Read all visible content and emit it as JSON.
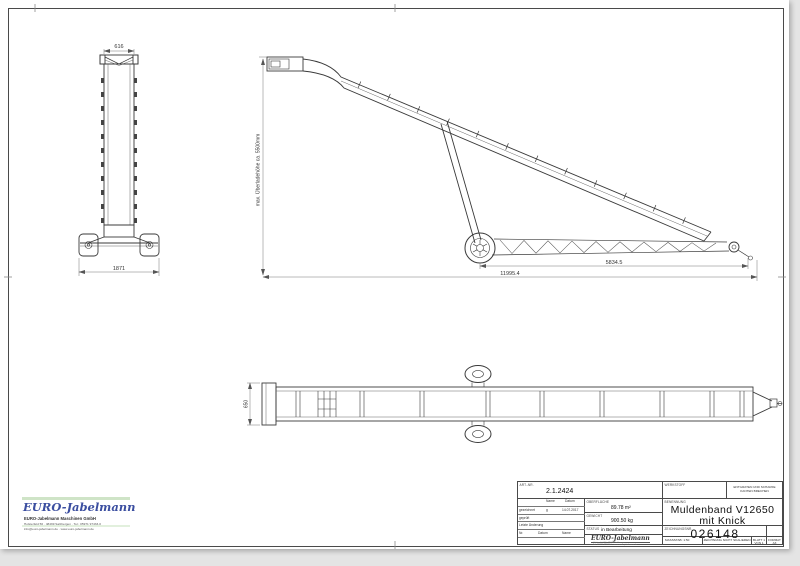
{
  "colors": {
    "line": "#3a3a3a",
    "dim": "#6a6a6a",
    "logo_blue": "#3b4ea0",
    "accent_green": "#cfe4c7",
    "sheet": "#ffffff",
    "backdrop": "#e4e4e4"
  },
  "drawing": {
    "front_view": {
      "width_dim": "616",
      "track_dim": "1871"
    },
    "side_view": {
      "height_dim": "max. Überladehöhe ca. 5500mm",
      "partial_dim": "5834.5",
      "length_dim": "11995.4"
    },
    "top_view": {
      "belt_width_dim": "650"
    }
  },
  "corner_logo": {
    "brand": "EURO-Jabelmann",
    "company": "EURO-Jabelmann Maschinen GmbH",
    "line1": "Holsterfeld 56 · 48499 Salzbergen · Tel.: 05971 97433-0",
    "line2": "info@euro-jabelmann.de · www.euro-jabelmann.de"
  },
  "title_block": {
    "art_nr_label": "ART.-NR.",
    "art_nr": "2.1.2424",
    "rev_table": {
      "col_name": "Name",
      "col_datum": "Datum",
      "drawn_label": "gezeichnet",
      "drawn_name": "g",
      "drawn_date": "14.07.2017",
      "checked_label": "geprüft",
      "last_change_label": "Letzte Änderung",
      "col_nr": "Nr.",
      "col_datum2": "Datum",
      "col_name2": "Name"
    },
    "surface_label": "OBERFLÄCHE",
    "surface_value": "89.78 m²",
    "weight_label": "GEWICHT",
    "weight_value": "900.50 kg",
    "status_label": "STATUS",
    "status_value": "in Bearbeitung",
    "logo_text": "EURO-Jabelmann",
    "logo_addr1": "Holsterfeld 56, 48499 Salzbergen",
    "logo_addr2": "Tel. 05971 97433-0 · www.euro-jabelmann.de",
    "werkstoff_label": "WERKSTOFF",
    "deburr_note1": "ENTGRATEN UND SCHARFE",
    "deburr_note2": "KANTEN BRECHEN",
    "benennung_label": "BENENNUNG",
    "title_line1": "Muldenband V12650",
    "title_line2": "mit Knick",
    "zeichnungsnr_label": "ZEICHNUNGSNR.",
    "drawing_number": "026148",
    "massstab": "MASSSTAB: 1:50",
    "no_scale": "ZEICHNUNG NICHT SKALIEREN",
    "sheet": "BLATT 1 VON 1",
    "format": "FORMAT A3"
  }
}
